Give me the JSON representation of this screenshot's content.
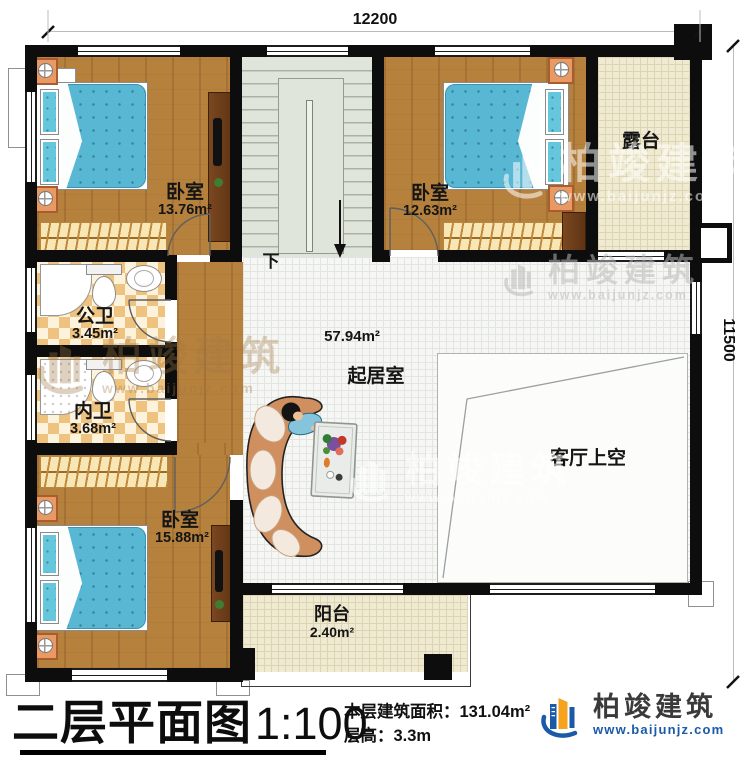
{
  "plan": {
    "dimensions": {
      "width_mm": "12200",
      "height_mm": "11500"
    },
    "rooms": {
      "bedroom_top_left": {
        "name": "卧室",
        "area": "13.76m²"
      },
      "bedroom_top_right": {
        "name": "卧室",
        "area": "12.63m²"
      },
      "bedroom_bottom_left": {
        "name": "卧室",
        "area": "15.88m²"
      },
      "public_bathroom": {
        "name": "公卫",
        "area": "3.45m²"
      },
      "ensuite_bathroom": {
        "name": "内卫",
        "area": "3.68m²"
      },
      "terrace": {
        "name": "露台"
      },
      "balcony": {
        "name": "阳台",
        "area": "2.40m²"
      },
      "living_room": {
        "name": "起居室",
        "area": "57.94m²"
      },
      "living_void": {
        "name": "客厅上空"
      },
      "stairs": {
        "direction_label": "下"
      }
    }
  },
  "footer": {
    "title": "二层平面图",
    "scale": "1:100",
    "area_label": "本层建筑面积：",
    "area_value": "131.04m²",
    "floor_height_label": "层高：",
    "floor_height_value": "3.3m"
  },
  "brand": {
    "name": "柏竣建筑",
    "website": "www.baijunjz.com"
  },
  "watermark": {
    "name": "柏竣建筑",
    "website": "www.baijunjz.com"
  },
  "palette": {
    "wall": "#0d0d0d",
    "wood_floor": "#b5813d",
    "bathroom_tile": "#eec27f",
    "terrace_floor": "#efead1",
    "stair_floor": "#dfe5db",
    "bed": "#57b7d3",
    "brand_blue": "#1b5aa8",
    "brand_orange": "#f6a21c"
  }
}
